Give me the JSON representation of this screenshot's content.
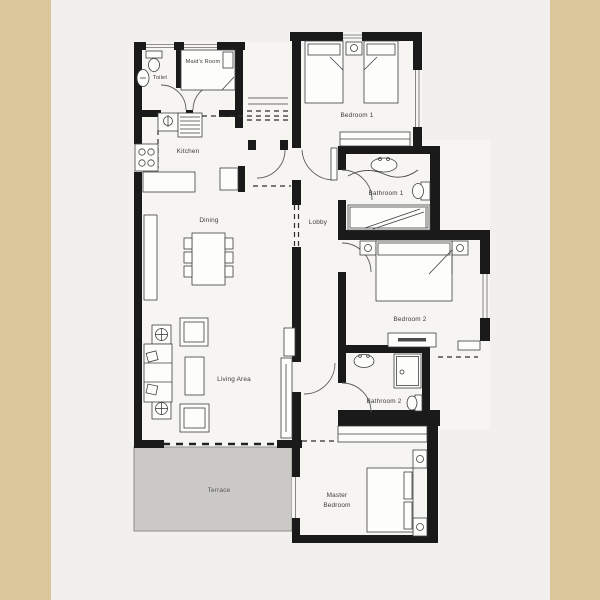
{
  "title": "Apartment Floor Plan",
  "colors": {
    "side_panel": "#dbc69c",
    "background": "#f1f0ec",
    "floor": "#f6f5f2",
    "wall": "#1a1a1a",
    "terrace_fill": "#cac9c5",
    "label": "#3b3b3b"
  },
  "rooms": {
    "toilet": {
      "label": "Toilet"
    },
    "maids_room": {
      "label": "Maid's Room"
    },
    "kitchen": {
      "label": "Kitchen"
    },
    "dining": {
      "label": "Dining"
    },
    "lobby": {
      "label": "Lobby"
    },
    "living_area": {
      "label": "Living Area"
    },
    "terrace": {
      "label": "Terrace"
    },
    "bedroom1": {
      "label": "Bedroom 1"
    },
    "bathroom1": {
      "label": "Bathroom 1"
    },
    "bedroom2": {
      "label": "Bedroom 2"
    },
    "bathroom2": {
      "label": "Bathroom 2"
    },
    "master_bedroom": {
      "label_line1": "Master",
      "label_line2": "Bedroom"
    }
  }
}
